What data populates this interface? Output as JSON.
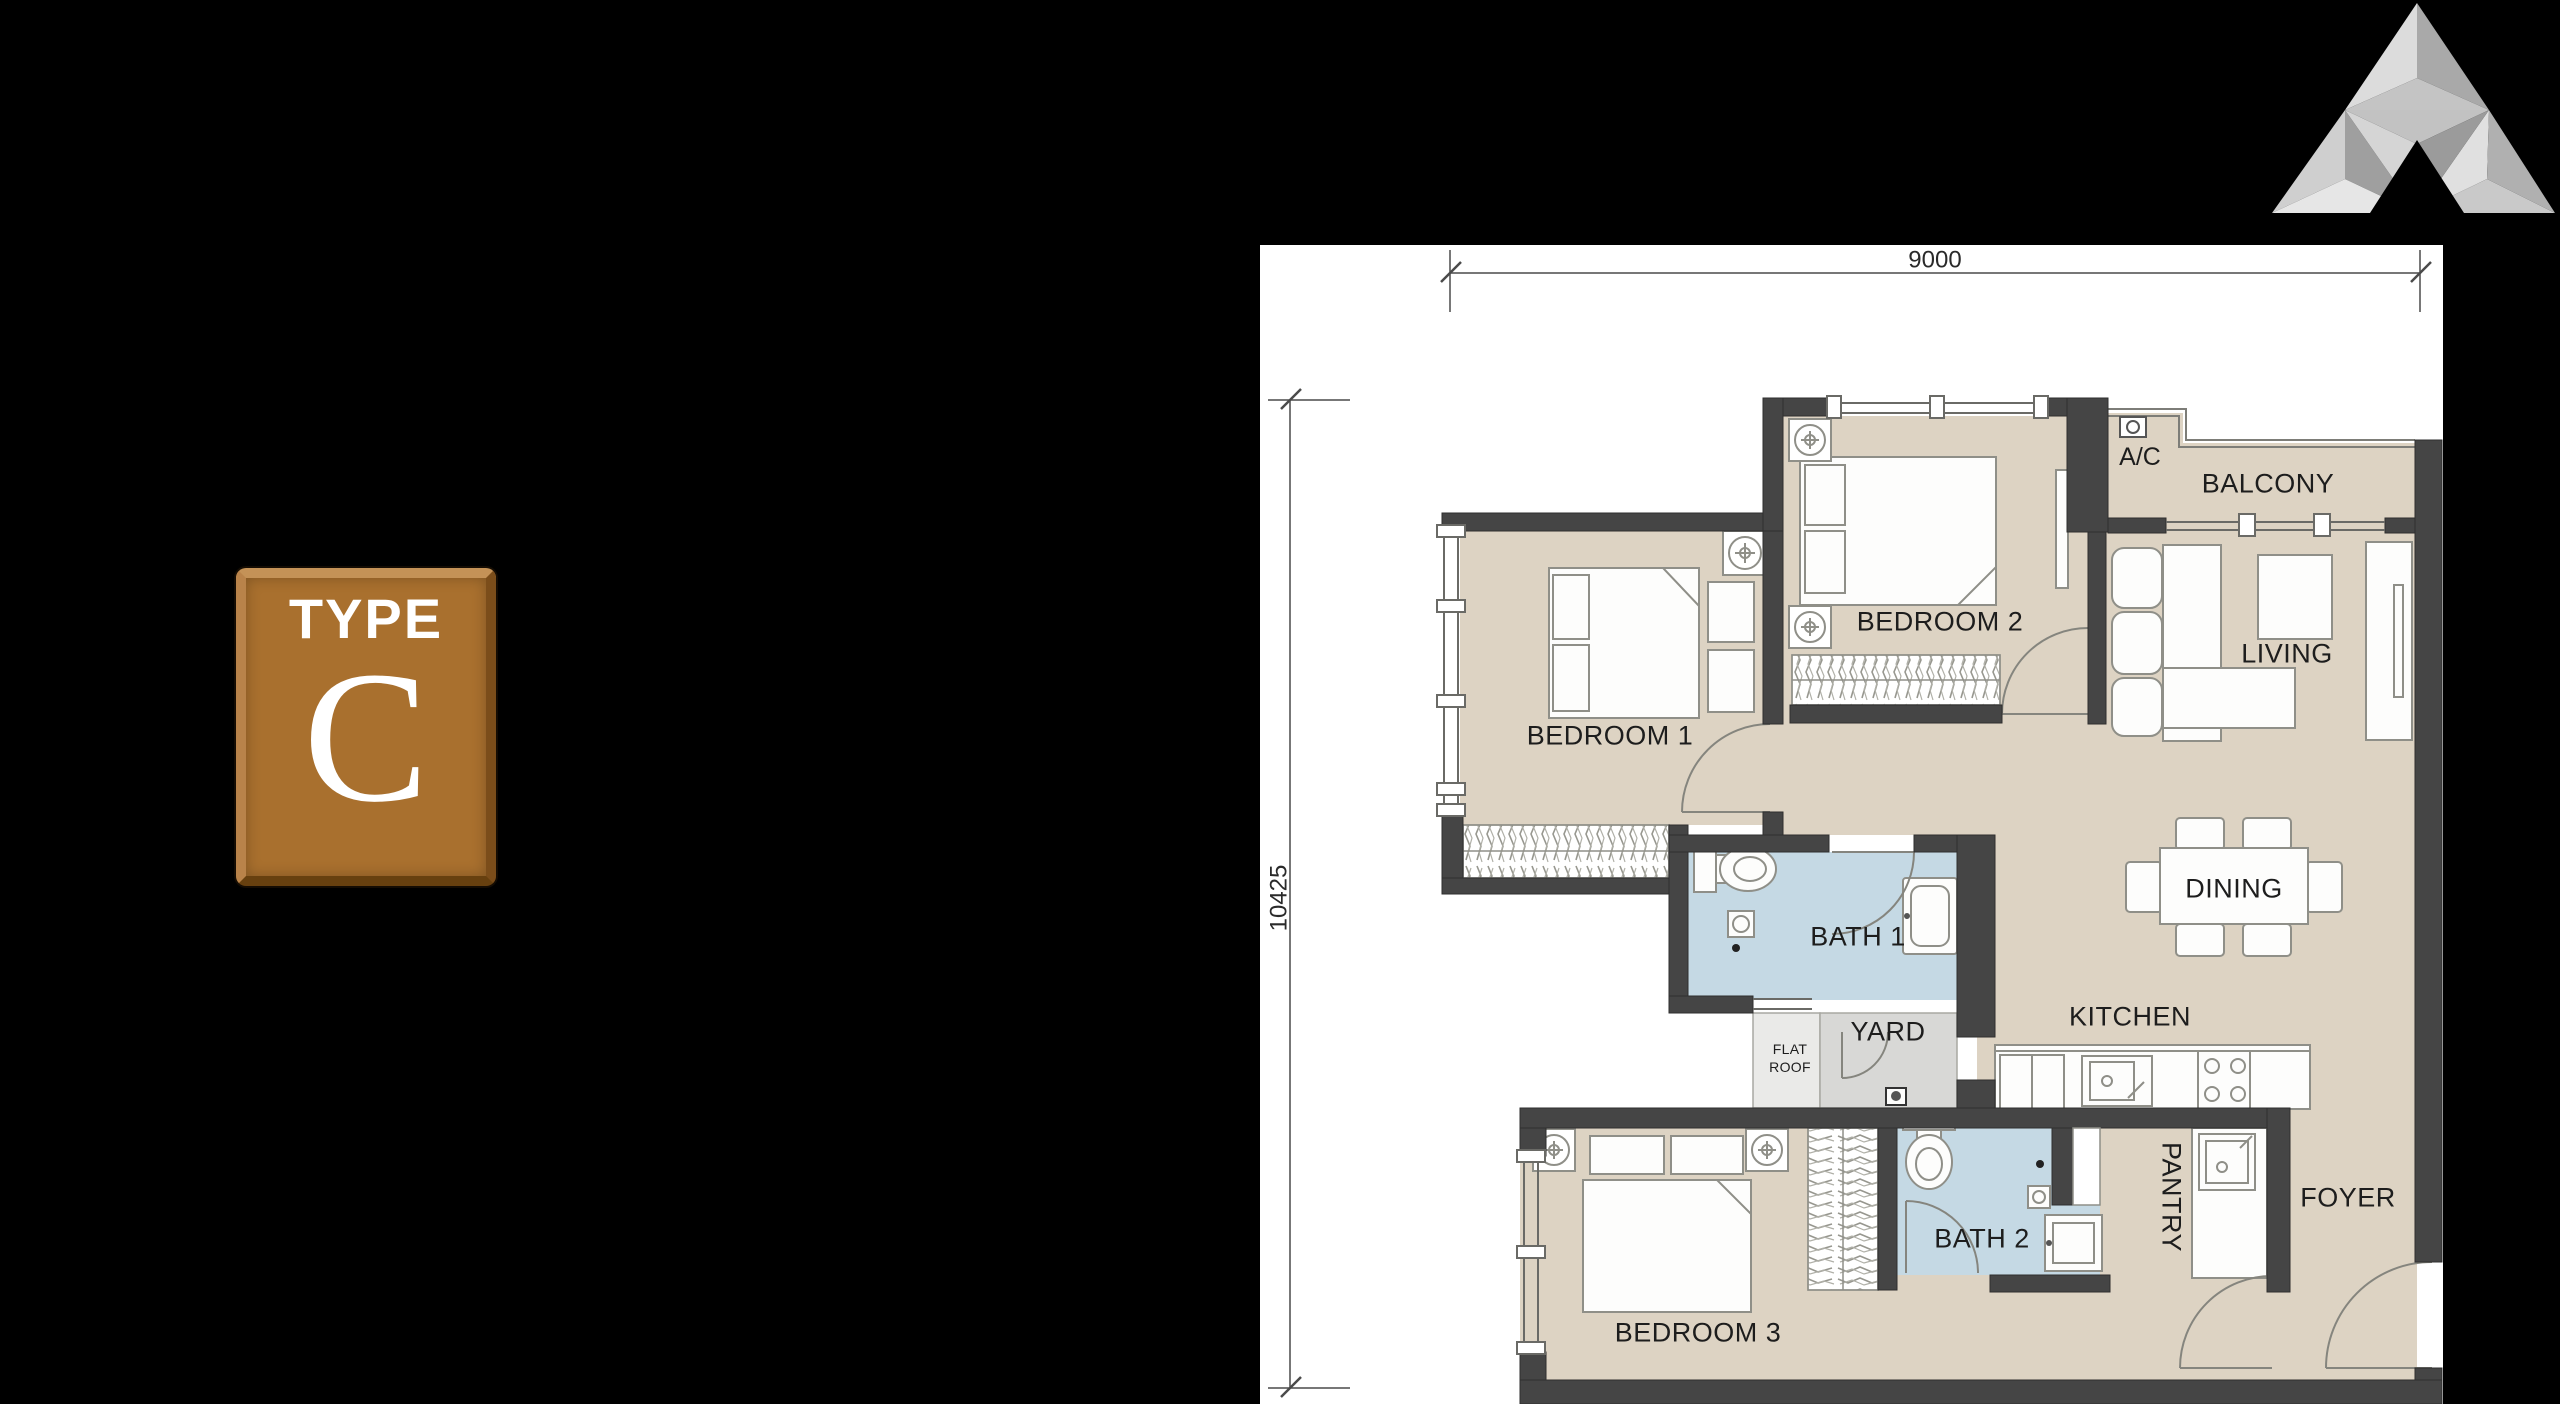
{
  "badge": {
    "label": "TYPE",
    "letter": "C",
    "color": "#a9702e"
  },
  "logo": {
    "name": "developer-logo-triangle"
  },
  "floor_plan": {
    "dimension_width": "9000",
    "dimension_height": "10425",
    "rooms": {
      "bedroom1": "BEDROOM 1",
      "bedroom2": "BEDROOM 2",
      "bedroom3": "BEDROOM 3",
      "bath1": "BATH 1",
      "bath2": "BATH 2",
      "living": "LIVING",
      "dining": "DINING",
      "kitchen": "KITCHEN",
      "pantry": "PANTRY",
      "foyer": "FOYER",
      "balcony": "BALCONY",
      "yard": "YARD",
      "ac_ledge": "A/C",
      "flat_roof_line1": "FLAT",
      "flat_roof_line2": "ROOF"
    },
    "colors": {
      "paper": "#ffffff",
      "wall": "#454545",
      "floor": "#ddd3c3",
      "bath_floor": "#c5d9e4",
      "yard_floor": "#d8d8d6",
      "flat_roof_floor": "#eaeae8"
    }
  }
}
